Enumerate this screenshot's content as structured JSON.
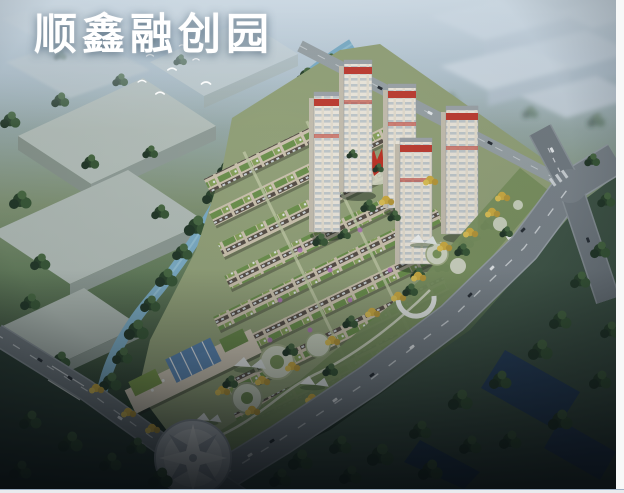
{
  "window": {
    "width": 624,
    "height": 493
  },
  "title": {
    "text": "顺鑫融创园"
  },
  "scene": {
    "type": "aerial-architectural-rendering",
    "subject": "residential development masterplan bird's-eye view",
    "highrise_towers": 5,
    "townhouse_rows": 8,
    "landmark": "red sculpture",
    "water_feature": "winding canal",
    "entrance_plaza": "circular star-pattern plaza",
    "canopy_structures": 4,
    "roads": "boulevard with four-way intersection"
  },
  "palette": {
    "sky_haze": "#b7c8d5",
    "canal_water": "#7fb0c9",
    "warehouse_gray": "#b4bfba",
    "townhouse_beige": "#cfc6b2",
    "roof_garden_green": "#6f9450",
    "tower_facade": "#efeadf",
    "tower_banner_red": "#c04035",
    "road_asphalt": "#7e878e",
    "tree_dark": "#2c452f",
    "tree_autumn": "#cfae45",
    "plaza_paving": "#dde1e4",
    "field_green": "#42584a",
    "glass_blue": "#5a88b8",
    "frame_white": "#f7f8f8"
  }
}
